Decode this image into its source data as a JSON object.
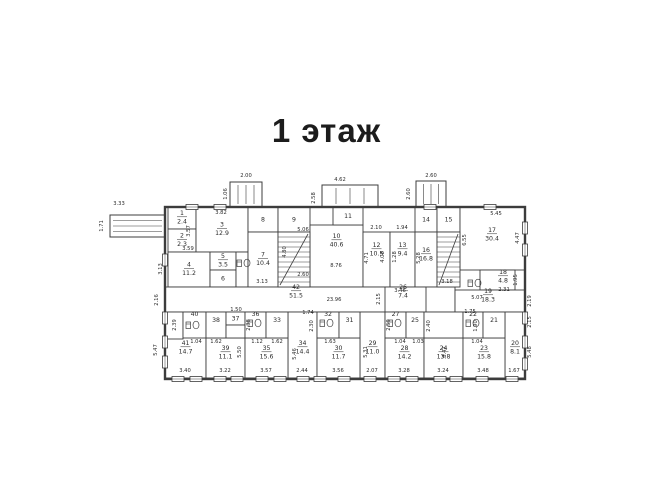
{
  "title": "1 этаж",
  "plan": {
    "colors": {
      "line": "#3c3c3c",
      "text": "#2b2b2b",
      "bg": "#ffffff"
    },
    "outline": {
      "x": 165,
      "y": 207,
      "w": 360,
      "h": 172
    },
    "rooms": [
      {
        "n": "1",
        "a": "2.4",
        "x": 168,
        "y": 207,
        "w": 28,
        "h": 22
      },
      {
        "n": "2",
        "a": "2.3",
        "x": 168,
        "y": 229,
        "w": 28,
        "h": 23
      },
      {
        "n": "3",
        "a": "12.9",
        "x": 196,
        "y": 207,
        "w": 52,
        "h": 45
      },
      {
        "n": "4",
        "a": "11.2",
        "x": 168,
        "y": 252,
        "w": 42,
        "h": 35
      },
      {
        "n": "5",
        "a": "3.5",
        "x": 210,
        "y": 252,
        "w": 26,
        "h": 18
      },
      {
        "n": "6",
        "a": "",
        "x": 210,
        "y": 270,
        "w": 26,
        "h": 17
      },
      {
        "n": "",
        "a": "",
        "x": 236,
        "y": 252,
        "w": 12,
        "h": 35
      },
      {
        "n": "8",
        "a": "",
        "x": 248,
        "y": 207,
        "w": 30,
        "h": 25
      },
      {
        "n": "9",
        "a": "",
        "x": 278,
        "y": 207,
        "w": 32,
        "h": 25
      },
      {
        "n": "7",
        "a": "10.4",
        "x": 248,
        "y": 232,
        "w": 30,
        "h": 55
      },
      {
        "n": "10",
        "a": "40.6",
        "x": 310,
        "y": 225,
        "w": 53,
        "h": 62,
        "ly": 238
      },
      {
        "n": "11",
        "a": "",
        "x": 333,
        "y": 207,
        "w": 30,
        "h": 18
      },
      {
        "n": "12",
        "a": "10.5",
        "x": 363,
        "y": 232,
        "w": 27,
        "h": 55,
        "ly": 247
      },
      {
        "n": "13",
        "a": "9.4",
        "x": 390,
        "y": 232,
        "w": 25,
        "h": 55,
        "ly": 247
      },
      {
        "n": "14",
        "a": "",
        "x": 415,
        "y": 207,
        "w": 22,
        "h": 25
      },
      {
        "n": "15",
        "a": "",
        "x": 437,
        "y": 207,
        "w": 23,
        "h": 25
      },
      {
        "n": "16",
        "a": "16.8",
        "x": 415,
        "y": 232,
        "w": 22,
        "h": 55,
        "ly": 252
      },
      {
        "n": "17",
        "a": "30.4",
        "x": 460,
        "y": 207,
        "w": 65,
        "h": 63,
        "lx": 492,
        "ly": 232
      },
      {
        "n": "18",
        "a": "4.8",
        "x": 480,
        "y": 270,
        "w": 35,
        "h": 20,
        "lx": 503,
        "ly": 274
      },
      {
        "n": "42",
        "a": "51.5",
        "x": 165,
        "y": 287,
        "w": 290,
        "h": 25,
        "lx": 296,
        "ly": 289
      },
      {
        "n": "26",
        "a": "7.4",
        "x": 385,
        "y": 287,
        "w": 41,
        "h": 25,
        "lx": 403,
        "ly": 289
      },
      {
        "n": "19",
        "a": "18.3",
        "x": 455,
        "y": 290,
        "w": 70,
        "h": 22,
        "lx": 488,
        "ly": 293
      },
      {
        "n": "41",
        "a": "14.7",
        "x": 165,
        "y": 312,
        "w": 41,
        "h": 66,
        "ly": 345
      },
      {
        "n": "34",
        "a": "14.4",
        "x": 288,
        "y": 312,
        "w": 29,
        "h": 66,
        "ly": 345
      },
      {
        "n": "29",
        "a": "11.0",
        "x": 360,
        "y": 312,
        "w": 25,
        "h": 66,
        "ly": 345
      },
      {
        "n": "20",
        "a": "8.1",
        "x": 505,
        "y": 312,
        "w": 20,
        "h": 66,
        "ly": 345
      },
      {
        "n": "39",
        "a": "11.1",
        "x": 206,
        "y": 338,
        "w": 39,
        "h": 40,
        "ly": 350
      },
      {
        "n": "35",
        "a": "15.6",
        "x": 245,
        "y": 338,
        "w": 43,
        "h": 40,
        "ly": 350
      },
      {
        "n": "30",
        "a": "11.7",
        "x": 317,
        "y": 338,
        "w": 43,
        "h": 40,
        "ly": 350
      },
      {
        "n": "28",
        "a": "14.2",
        "x": 385,
        "y": 338,
        "w": 39,
        "h": 40,
        "ly": 350
      },
      {
        "n": "24",
        "a": "13.8",
        "x": 424,
        "y": 338,
        "w": 39,
        "h": 40,
        "ly": 350
      },
      {
        "n": "23",
        "a": "15.8",
        "x": 463,
        "y": 338,
        "w": 42,
        "h": 40,
        "ly": 350
      },
      {
        "n": "",
        "a": "",
        "x": 165,
        "y": 312,
        "w": 18,
        "h": 27
      },
      {
        "n": "40",
        "a": "",
        "x": 183,
        "y": 312,
        "w": 23,
        "h": 26,
        "ly": 316
      },
      {
        "n": "38",
        "a": "",
        "x": 206,
        "y": 312,
        "w": 20,
        "h": 26,
        "ly": 322
      },
      {
        "n": "37",
        "a": "",
        "x": 226,
        "y": 312,
        "w": 19,
        "h": 13
      },
      {
        "n": "",
        "a": "",
        "x": 226,
        "y": 325,
        "w": 19,
        "h": 13
      },
      {
        "n": "36",
        "a": "",
        "x": 245,
        "y": 312,
        "w": 21,
        "h": 26,
        "ly": 316
      },
      {
        "n": "33",
        "a": "",
        "x": 266,
        "y": 312,
        "w": 22,
        "h": 26,
        "ly": 322
      },
      {
        "n": "32",
        "a": "",
        "x": 317,
        "y": 312,
        "w": 22,
        "h": 26,
        "ly": 316
      },
      {
        "n": "31",
        "a": "",
        "x": 339,
        "y": 312,
        "w": 21,
        "h": 26,
        "ly": 322
      },
      {
        "n": "27",
        "a": "",
        "x": 385,
        "y": 312,
        "w": 21,
        "h": 26,
        "ly": 316
      },
      {
        "n": "25",
        "a": "",
        "x": 406,
        "y": 312,
        "w": 18,
        "h": 26,
        "ly": 322
      },
      {
        "n": "",
        "a": "",
        "x": 424,
        "y": 312,
        "w": 39,
        "h": 26
      },
      {
        "n": "22",
        "a": "",
        "x": 463,
        "y": 312,
        "w": 20,
        "h": 26,
        "ly": 316
      },
      {
        "n": "21",
        "a": "",
        "x": 483,
        "y": 312,
        "w": 22,
        "h": 26,
        "ly": 322
      }
    ],
    "porches": [
      {
        "x": 110,
        "y": 215,
        "w": 55,
        "h": 22,
        "dir": "h"
      },
      {
        "x": 230,
        "y": 182,
        "w": 32,
        "h": 25,
        "dir": "v"
      },
      {
        "x": 322,
        "y": 185,
        "w": 56,
        "h": 22,
        "dir": "v"
      },
      {
        "x": 416,
        "y": 181,
        "w": 30,
        "h": 26,
        "dir": "v"
      }
    ],
    "stairs": [
      {
        "x": 278,
        "y": 232,
        "w": 32,
        "h": 55
      },
      {
        "x": 437,
        "y": 232,
        "w": 23,
        "h": 55
      }
    ],
    "windows": {
      "bottom": [
        178,
        196,
        220,
        237,
        262,
        280,
        303,
        320,
        344,
        370,
        394,
        412,
        440,
        456,
        482,
        512
      ],
      "top": [
        192,
        220,
        430,
        490
      ],
      "left": [
        260,
        318,
        342,
        362
      ],
      "right": [
        228,
        250,
        318,
        342,
        364
      ]
    },
    "fixtures": [
      {
        "x": 186,
        "y": 318
      },
      {
        "x": 248,
        "y": 316
      },
      {
        "x": 320,
        "y": 316
      },
      {
        "x": 388,
        "y": 316
      },
      {
        "x": 466,
        "y": 316
      },
      {
        "x": 237,
        "y": 256
      },
      {
        "x": 468,
        "y": 276
      }
    ],
    "dims": [
      {
        "t": "3.33",
        "x": 119,
        "y": 205
      },
      {
        "t": "1.71",
        "x": 103,
        "y": 226,
        "r": 1
      },
      {
        "t": "2.00",
        "x": 246,
        "y": 177
      },
      {
        "t": "1.06",
        "x": 227,
        "y": 194,
        "r": 1
      },
      {
        "t": "4.62",
        "x": 340,
        "y": 181
      },
      {
        "t": "2.58",
        "x": 315,
        "y": 198,
        "r": 1
      },
      {
        "t": "2.60",
        "x": 431,
        "y": 177
      },
      {
        "t": "2.60",
        "x": 410,
        "y": 194,
        "r": 1
      },
      {
        "t": "3.82",
        "x": 221,
        "y": 214
      },
      {
        "t": "3.57",
        "x": 190,
        "y": 231,
        "r": 1
      },
      {
        "t": "5.06",
        "x": 303,
        "y": 231
      },
      {
        "t": "2.10",
        "x": 376,
        "y": 229
      },
      {
        "t": "1.94",
        "x": 402,
        "y": 229
      },
      {
        "t": "5.45",
        "x": 496,
        "y": 215
      },
      {
        "t": "3.59",
        "x": 188,
        "y": 250
      },
      {
        "t": "3.13",
        "x": 162,
        "y": 269,
        "r": 1
      },
      {
        "t": "4.80",
        "x": 286,
        "y": 252,
        "r": 1
      },
      {
        "t": "8.76",
        "x": 336,
        "y": 267
      },
      {
        "t": "2.60",
        "x": 303,
        "y": 276
      },
      {
        "t": "4.71",
        "x": 368,
        "y": 258,
        "r": 1
      },
      {
        "t": "4.08",
        "x": 384,
        "y": 257,
        "r": 1
      },
      {
        "t": "1.28",
        "x": 396,
        "y": 257,
        "r": 1
      },
      {
        "t": "5.28",
        "x": 420,
        "y": 258,
        "r": 1
      },
      {
        "t": "6.55",
        "x": 466,
        "y": 240,
        "r": 1
      },
      {
        "t": "4.47",
        "x": 519,
        "y": 238,
        "r": 1
      },
      {
        "t": "3.13",
        "x": 262,
        "y": 283
      },
      {
        "t": "3.18",
        "x": 447,
        "y": 283
      },
      {
        "t": "1.95",
        "x": 517,
        "y": 280,
        "r": 1
      },
      {
        "t": "2.31",
        "x": 504,
        "y": 291
      },
      {
        "t": "2.19",
        "x": 531,
        "y": 301,
        "r": 1
      },
      {
        "t": "5.07",
        "x": 477,
        "y": 299
      },
      {
        "t": "23.96",
        "x": 334,
        "y": 301
      },
      {
        "t": "2.16",
        "x": 158,
        "y": 300,
        "r": 1
      },
      {
        "t": "2.15",
        "x": 380,
        "y": 299,
        "r": 1
      },
      {
        "t": "3.46",
        "x": 400,
        "y": 292
      },
      {
        "t": "2.15",
        "x": 531,
        "y": 322,
        "r": 1
      },
      {
        "t": "5.47",
        "x": 157,
        "y": 350,
        "r": 1
      },
      {
        "t": "2.39",
        "x": 176,
        "y": 325,
        "r": 1
      },
      {
        "t": "1.04",
        "x": 196,
        "y": 343
      },
      {
        "t": "1.62",
        "x": 216,
        "y": 343
      },
      {
        "t": "1.50",
        "x": 236,
        "y": 311
      },
      {
        "t": "2.38",
        "x": 250,
        "y": 325,
        "r": 1
      },
      {
        "t": "1.12",
        "x": 257,
        "y": 343
      },
      {
        "t": "1.62",
        "x": 277,
        "y": 343
      },
      {
        "t": "1.74",
        "x": 308,
        "y": 314
      },
      {
        "t": "2.30",
        "x": 313,
        "y": 326,
        "r": 1
      },
      {
        "t": "1.63",
        "x": 330,
        "y": 343
      },
      {
        "t": "5.50",
        "x": 241,
        "y": 352,
        "r": 1
      },
      {
        "t": "5.46",
        "x": 296,
        "y": 354,
        "r": 1
      },
      {
        "t": "5.31",
        "x": 367,
        "y": 352,
        "r": 1
      },
      {
        "t": "2.59",
        "x": 390,
        "y": 325,
        "r": 1
      },
      {
        "t": "1.04",
        "x": 400,
        "y": 343
      },
      {
        "t": "1.03",
        "x": 418,
        "y": 343
      },
      {
        "t": "2.40",
        "x": 430,
        "y": 326,
        "r": 1
      },
      {
        "t": "8.47",
        "x": 446,
        "y": 352,
        "r": 1
      },
      {
        "t": "1.75",
        "x": 470,
        "y": 313
      },
      {
        "t": "1.90",
        "x": 477,
        "y": 326,
        "r": 1
      },
      {
        "t": "1.04",
        "x": 477,
        "y": 343
      },
      {
        "t": "5.48",
        "x": 531,
        "y": 352,
        "r": 1
      },
      {
        "t": "3.40",
        "x": 185,
        "y": 372
      },
      {
        "t": "3.22",
        "x": 225,
        "y": 372
      },
      {
        "t": "3.57",
        "x": 266,
        "y": 372
      },
      {
        "t": "2.44",
        "x": 302,
        "y": 372
      },
      {
        "t": "3.56",
        "x": 338,
        "y": 372
      },
      {
        "t": "2.07",
        "x": 372,
        "y": 372
      },
      {
        "t": "3.28",
        "x": 404,
        "y": 372
      },
      {
        "t": "3.24",
        "x": 443,
        "y": 372
      },
      {
        "t": "3.48",
        "x": 483,
        "y": 372
      },
      {
        "t": "1.67",
        "x": 514,
        "y": 372
      }
    ]
  }
}
